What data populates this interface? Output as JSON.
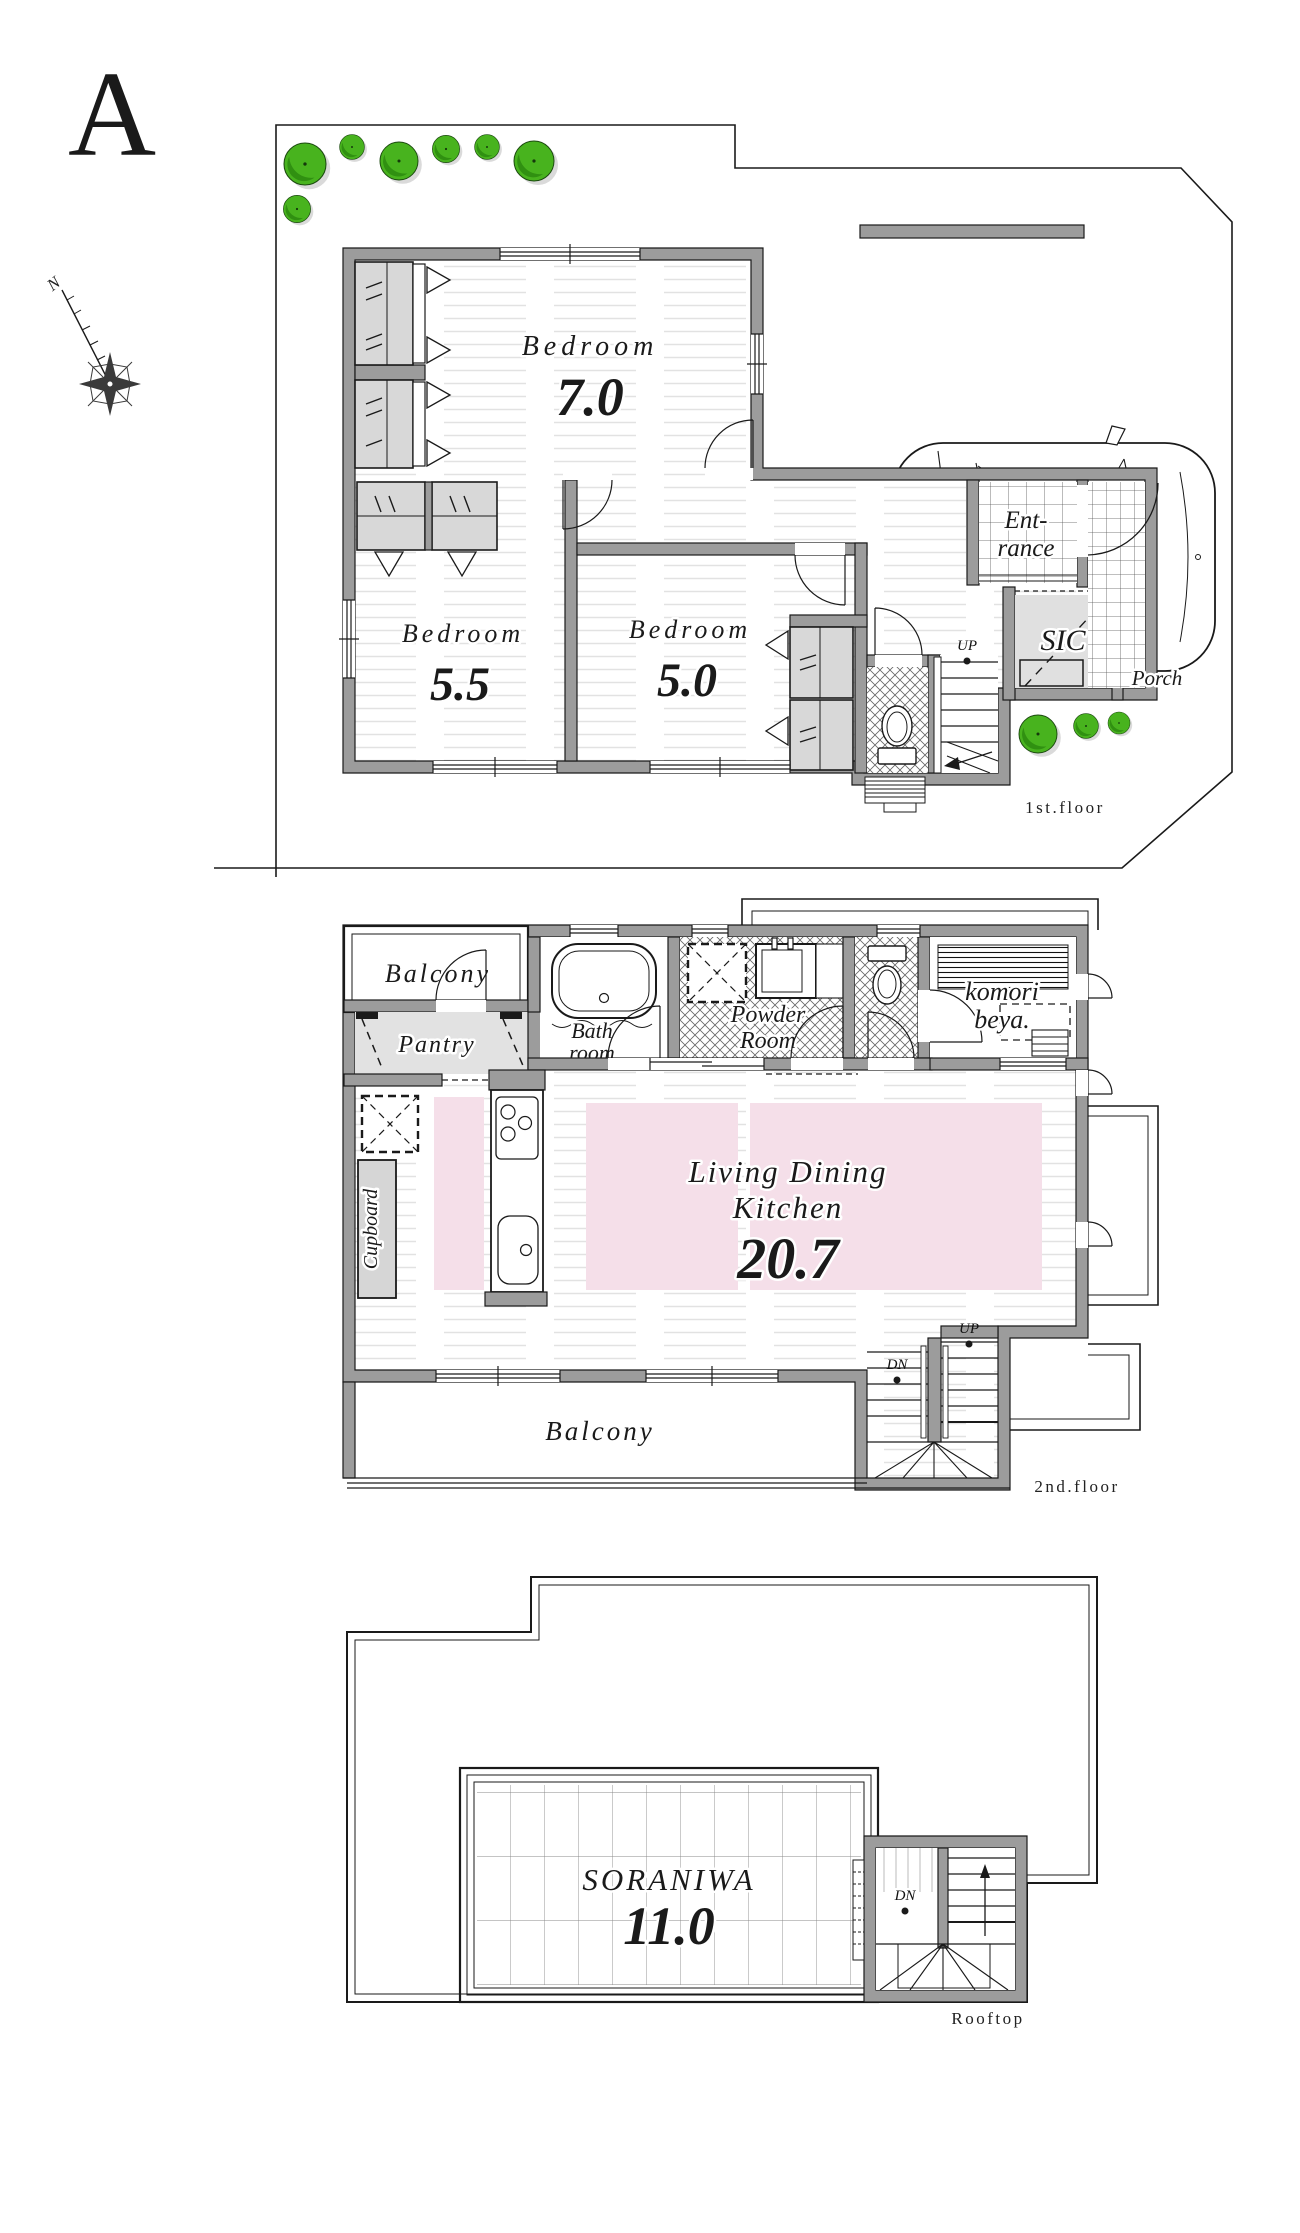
{
  "title": "A",
  "compass": {
    "north_label": "N"
  },
  "floor1": {
    "label": "1st.floor",
    "bedroom1": {
      "name": "Bedroom",
      "size": "7.0"
    },
    "bedroom2": {
      "name": "Bedroom",
      "size": "5.5"
    },
    "bedroom3": {
      "name": "Bedroom",
      "size": "5.0"
    },
    "entrance": {
      "line1": "Ent-",
      "line2": "rance"
    },
    "sic": {
      "name": "SIC"
    },
    "porch": {
      "name": "Porch"
    },
    "stairs": {
      "up": "UP"
    }
  },
  "floor2": {
    "label": "2nd.floor",
    "balcony_top": {
      "name": "Balcony"
    },
    "pantry": {
      "name": "Pantry"
    },
    "bathroom": {
      "line1": "Bath",
      "line2": "room"
    },
    "powder_room": {
      "line1": "Powder",
      "line2": "Room"
    },
    "komori_beya": {
      "line1": "komori",
      "line2": "beya."
    },
    "ldk": {
      "line1": "Living Dining",
      "line2": "Kitchen",
      "size": "20.7"
    },
    "cupboard": {
      "name": "Cupboard"
    },
    "balcony_bottom": {
      "name": "Balcony"
    },
    "stairs": {
      "up": "UP",
      "dn": "DN"
    }
  },
  "rooftop": {
    "label": "Rooftop",
    "soraniwa": {
      "name": "SORANIWA",
      "size": "11.0"
    },
    "stairs": {
      "dn": "DN"
    }
  },
  "colors": {
    "wall_gray": "#9c9c9c",
    "closet_gray": "#d8d8d8",
    "room_gray": "#e0e0e0",
    "rug_pink": "#f5dfe9",
    "tree_green": "#48b31e",
    "tree_dark": "#2e8c10",
    "line_black": "#1a1a1a"
  }
}
